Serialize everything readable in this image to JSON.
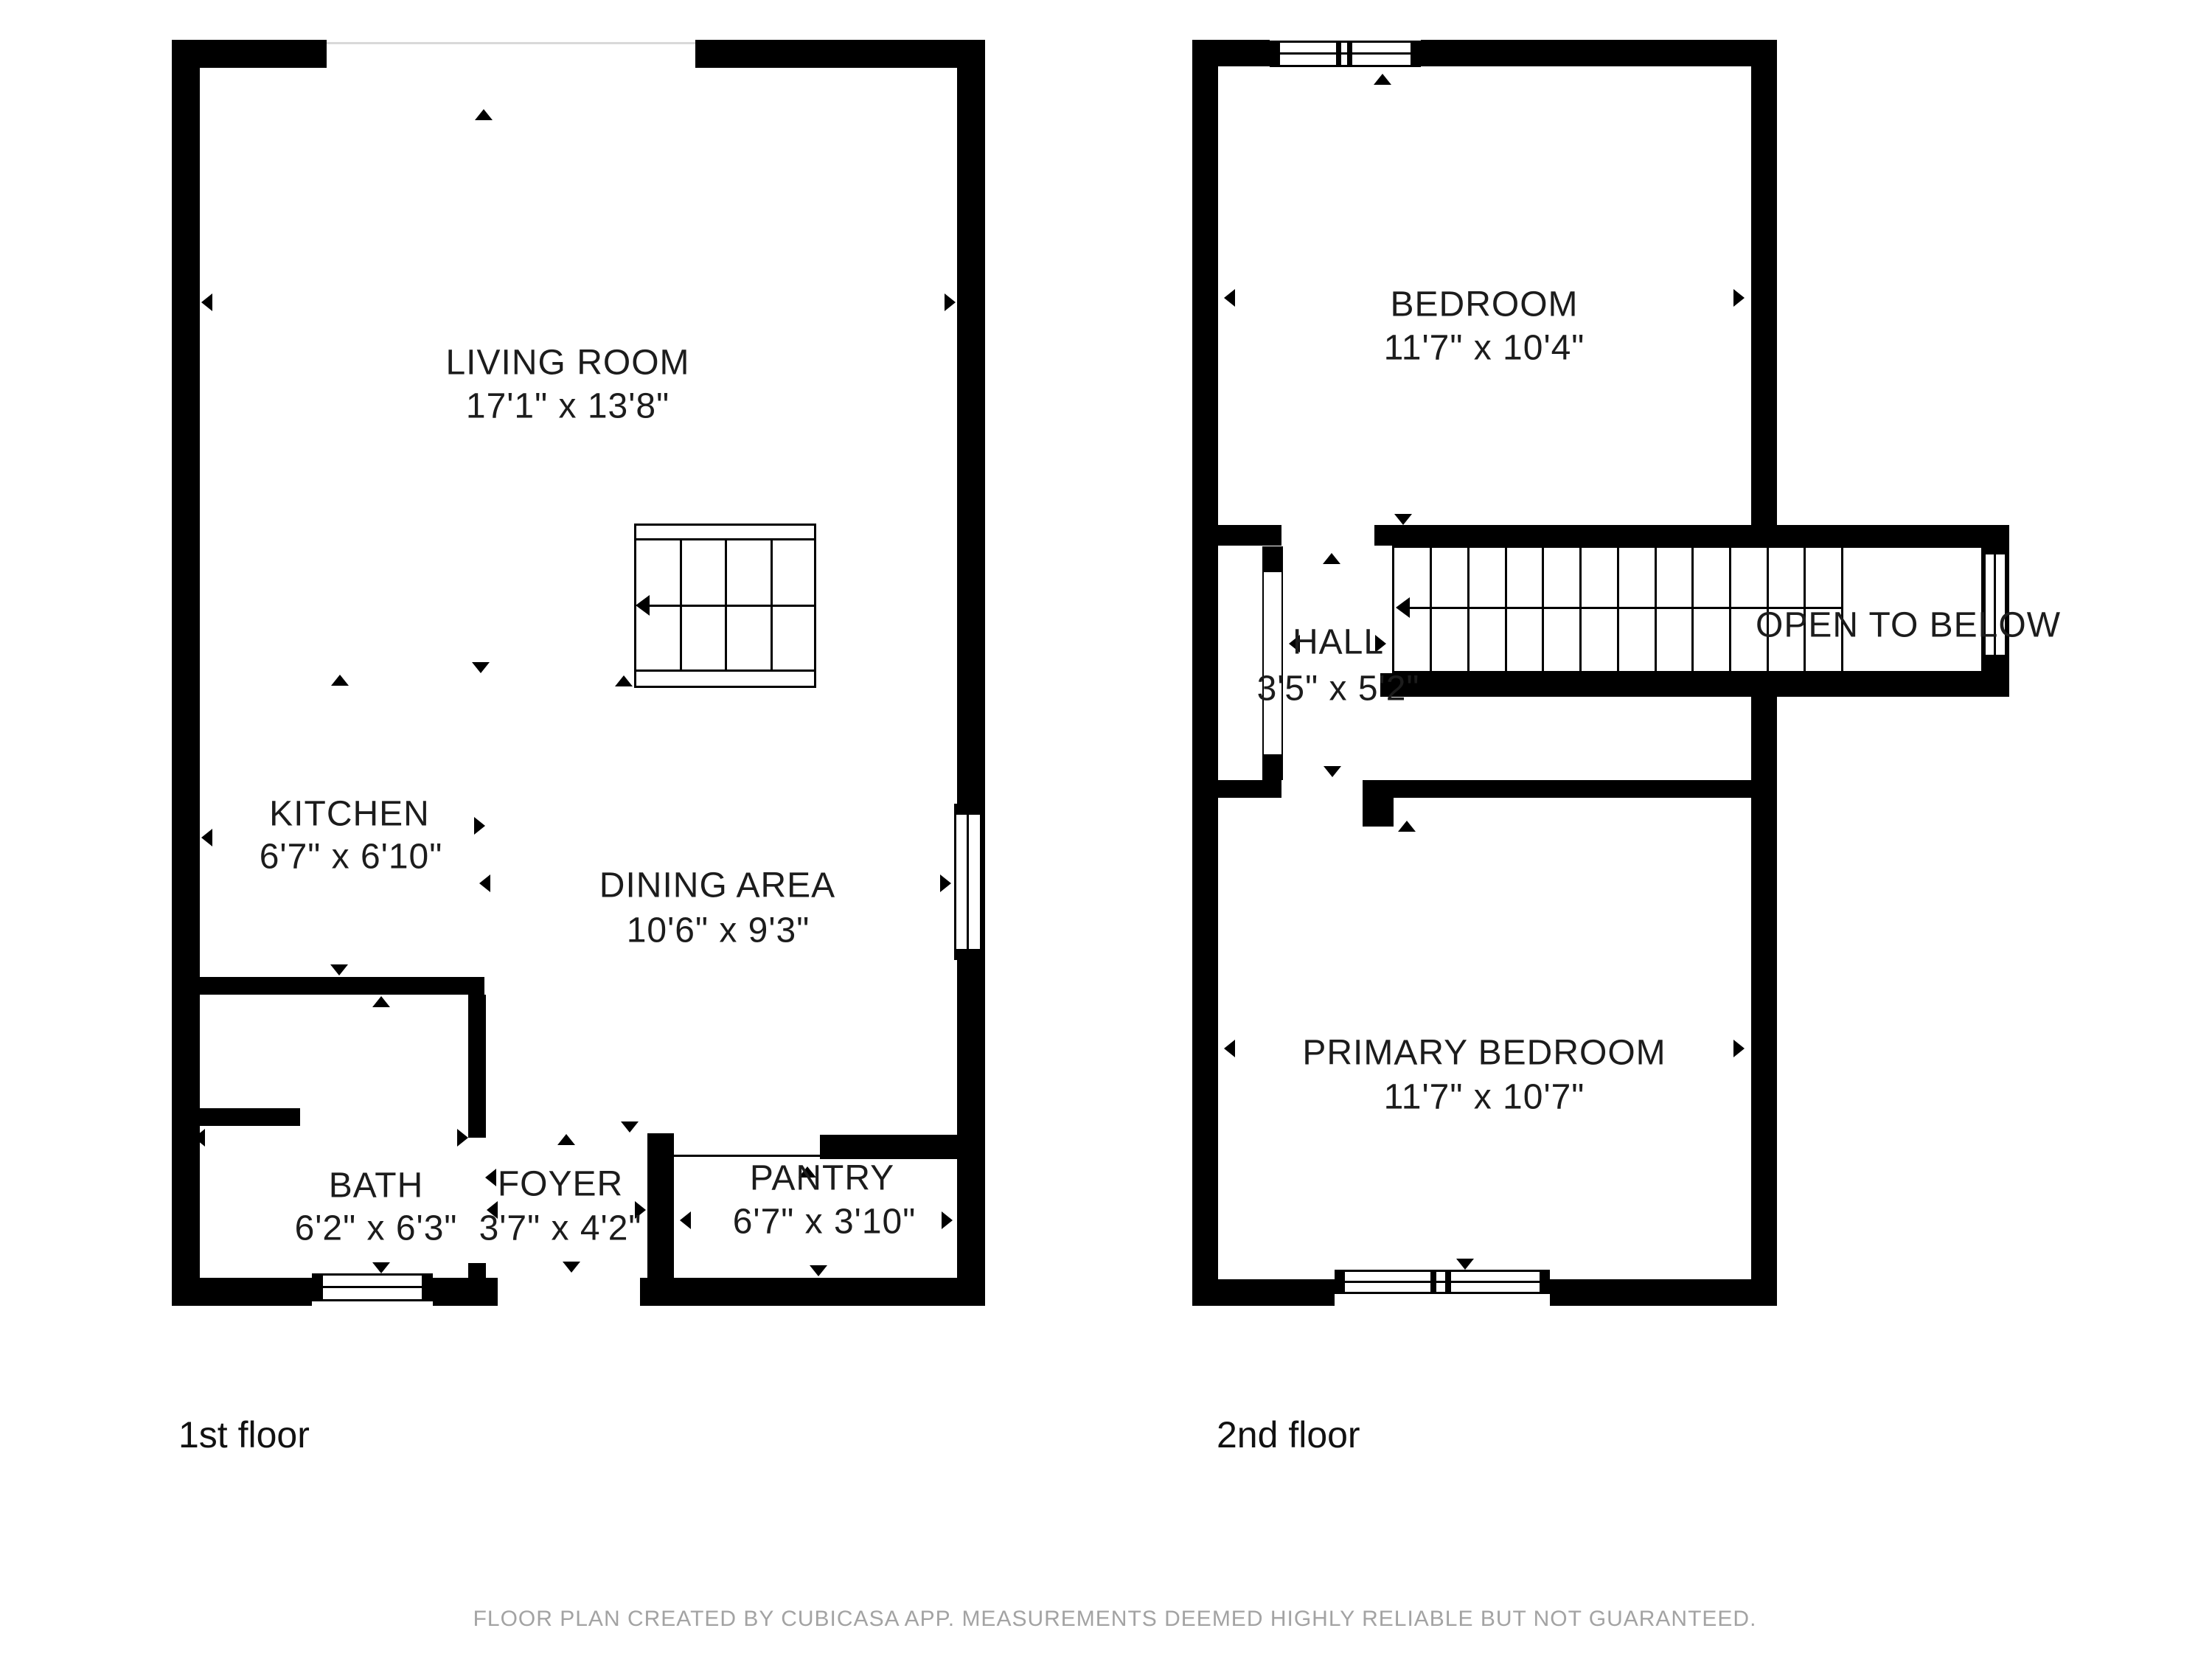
{
  "floor1": {
    "label": "1st floor",
    "rooms": {
      "living": {
        "name": "LIVING ROOM",
        "dims": "17'1\" x 13'8\""
      },
      "kitchen": {
        "name": "KITCHEN",
        "dims": "6'7\" x 6'10\""
      },
      "dining": {
        "name": "DINING AREA",
        "dims": "10'6\" x 9'3\""
      },
      "bath": {
        "name": "BATH",
        "dims": "6'2\" x 6'3\""
      },
      "foyer": {
        "name": "FOYER",
        "dims": "3'7\" x 4'2\""
      },
      "pantry": {
        "name": "PANTRY",
        "dims": "6'7\" x 3'10\""
      }
    }
  },
  "floor2": {
    "label": "2nd floor",
    "rooms": {
      "bedroom": {
        "name": "BEDROOM",
        "dims": "11'7\" x 10'4\""
      },
      "hall": {
        "name": "HALL",
        "dims": "3'5\" x 5'2\""
      },
      "primary": {
        "name": "PRIMARY BEDROOM",
        "dims": "11'7\" x 10'7\""
      }
    },
    "annotations": {
      "open_to_below": "OPEN TO BELOW"
    }
  },
  "footer": {
    "disclaimer": "FLOOR PLAN CREATED BY CUBICASA APP. MEASUREMENTS DEEMED HIGHLY RELIABLE BUT NOT GUARANTEED."
  },
  "colors": {
    "wall": "#000000",
    "label": "#1c1c1c",
    "disclaimer": "#a3a3a3"
  }
}
